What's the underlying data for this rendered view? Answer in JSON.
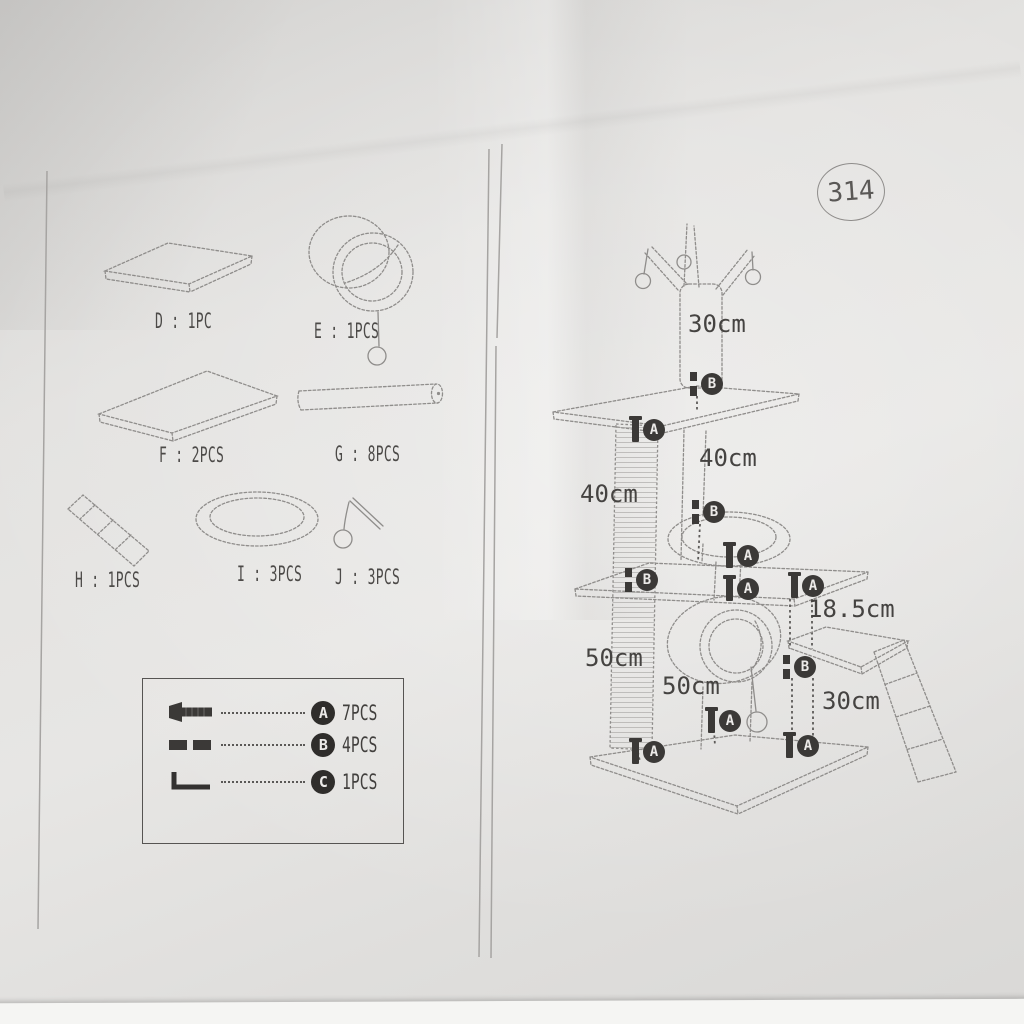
{
  "page": {
    "model_number": "314"
  },
  "parts": {
    "items": [
      {
        "id": "D",
        "label": "D : 1PC"
      },
      {
        "id": "E",
        "label": "E : 1PCS"
      },
      {
        "id": "F",
        "label": "F : 2PCS"
      },
      {
        "id": "G",
        "label": "G : 8PCS"
      },
      {
        "id": "H",
        "label": "H : 1PCS"
      },
      {
        "id": "I",
        "label": "I : 3PCS"
      },
      {
        "id": "J",
        "label": "J : 3PCS"
      }
    ]
  },
  "hardware": {
    "rows": [
      {
        "letter": "A",
        "qty": "7PCS"
      },
      {
        "letter": "B",
        "qty": "4PCS"
      },
      {
        "letter": "C",
        "qty": "1PCS"
      }
    ]
  },
  "diagram": {
    "measurements": [
      {
        "id": "top-post-height",
        "text": "30cm"
      },
      {
        "id": "upper-post-height",
        "text": "40cm"
      },
      {
        "id": "upper-scratch-post",
        "text": "40cm"
      },
      {
        "id": "side-shelf-post",
        "text": "18.5cm"
      },
      {
        "id": "lower-scratch-post",
        "text": "50cm"
      },
      {
        "id": "tunnel-length",
        "text": "50cm"
      },
      {
        "id": "lower-side-post",
        "text": "30cm"
      }
    ],
    "markers": [
      {
        "label": "B"
      },
      {
        "label": "A"
      },
      {
        "label": "B"
      },
      {
        "label": "A"
      },
      {
        "label": "A"
      },
      {
        "label": "B"
      },
      {
        "label": "A"
      },
      {
        "label": "B"
      },
      {
        "label": "A"
      },
      {
        "label": "A"
      },
      {
        "label": "A"
      }
    ]
  }
}
